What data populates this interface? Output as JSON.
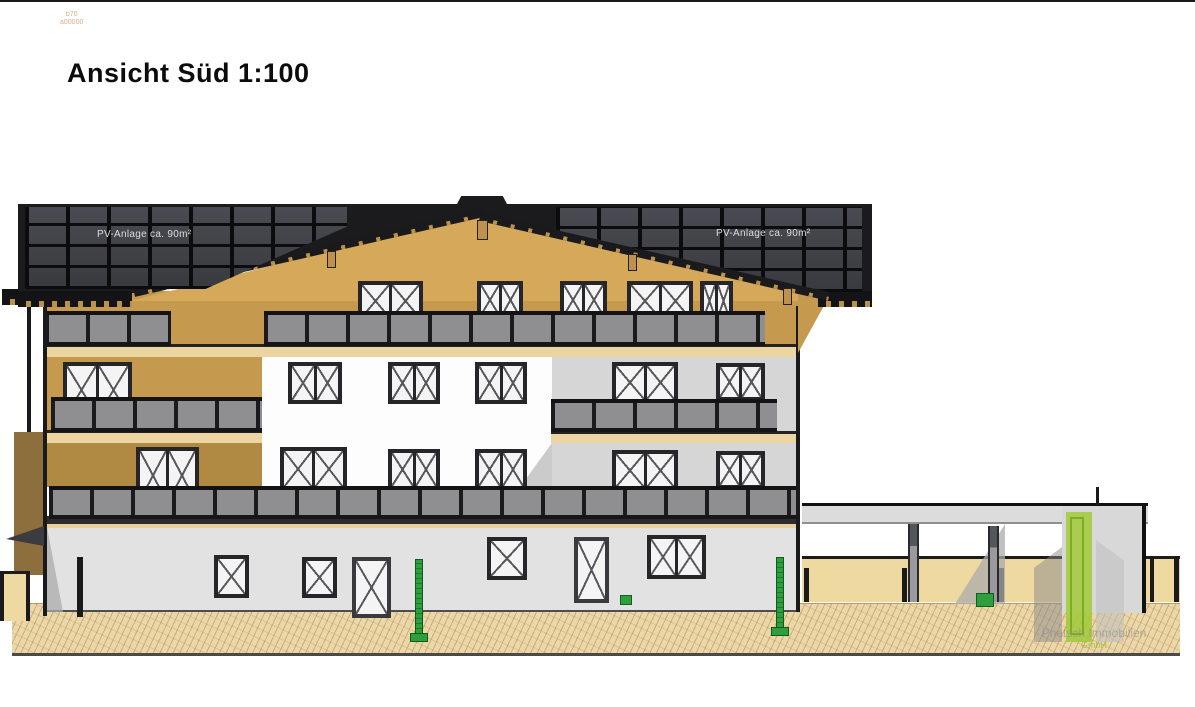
{
  "drawing": {
    "view": "Ansicht Süd",
    "scale": "1:100",
    "type": "architectural elevation"
  },
  "title": {
    "text": "Ansicht Süd 1:100"
  },
  "stamp": {
    "line1": "b70",
    "line2": "a00000"
  },
  "annotations": {
    "pv_left": "PV-Anlage ca. 90m²",
    "pv_right": "PV-Anlage ca. 90m²"
  },
  "logo": {
    "line1": "Prietsch Immobilien",
    "line2": "GmbH",
    "green": "#a3c93c",
    "gray": "#9a9a9a"
  },
  "colors": {
    "facade_wood": "#c69a4e",
    "facade_white": "#fdfdfd",
    "facade_gray": "#d6d6d6",
    "ground_floor": "#e2e2e2",
    "roof": "#1b1b1e",
    "pv_panel": "#43444a",
    "railing": "#8f8f92",
    "ground": "#ecd7a8",
    "bollard_green": "#2f9e3d"
  },
  "elevation": {
    "layers": [
      {
        "x": 0,
        "y": 0,
        "w": 1195,
        "h": 2,
        "c": "toprule",
        "n": "page-top-rule"
      },
      {
        "x": 12,
        "y": 603,
        "w": 1168,
        "h": 53,
        "c": "ground",
        "n": "ground-hatch"
      },
      {
        "x": 44,
        "y": 291,
        "w": 756,
        "h": 62,
        "c": "tan",
        "n": "attic-wall"
      },
      {
        "x": 130,
        "y": 213,
        "w": 706,
        "h": 88,
        "c": "tan-light",
        "n": "gable-wall",
        "cp": "polygon(50% 0%,100% 100%,0% 100%)"
      },
      {
        "x": 44,
        "y": 352,
        "w": 218,
        "h": 135,
        "c": "tan",
        "n": "left-wing-wall"
      },
      {
        "x": 44,
        "y": 443,
        "w": 218,
        "h": 44,
        "c": "tan-dark",
        "n": "left-wing-wall-shaded"
      },
      {
        "x": 262,
        "y": 352,
        "w": 290,
        "h": 135,
        "c": "white-wall",
        "n": "center-wall"
      },
      {
        "x": 520,
        "y": 443,
        "w": 32,
        "h": 44,
        "c": "shadow",
        "n": "center-wall-shadow",
        "cp": "polygon(100% 0,100% 100%,0 100%)"
      },
      {
        "x": 552,
        "y": 352,
        "w": 246,
        "h": 135,
        "c": "gray-wall",
        "n": "right-wing-wall"
      },
      {
        "x": 47,
        "y": 527,
        "w": 751,
        "h": 85,
        "c": "gf-wall",
        "n": "ground-floor-wall"
      },
      {
        "x": 47,
        "y": 527,
        "w": 16,
        "h": 85,
        "c": "shadow2",
        "n": "ground-floor-shadow",
        "cp": "polygon(0 0,100% 100%,0 100%)"
      },
      {
        "x": 44,
        "y": 344,
        "w": 754,
        "h": 13,
        "c": "band",
        "n": "floor-band-attic"
      },
      {
        "x": 44,
        "y": 430,
        "w": 218,
        "h": 13,
        "c": "band",
        "n": "floor-band-left"
      },
      {
        "x": 551,
        "y": 431,
        "w": 247,
        "h": 12,
        "c": "band",
        "n": "floor-band-right"
      },
      {
        "x": 44,
        "y": 516,
        "w": 754,
        "h": 12,
        "c": "band-dark",
        "n": "floor-band-ground"
      },
      {
        "t": "win",
        "x": 358,
        "y": 281,
        "w": 65,
        "h": 40,
        "p": 2,
        "n": "attic-window"
      },
      {
        "t": "win",
        "x": 477,
        "y": 281,
        "w": 46,
        "h": 38,
        "p": 2,
        "n": "attic-window"
      },
      {
        "t": "win",
        "x": 560,
        "y": 281,
        "w": 47,
        "h": 38,
        "p": 2,
        "n": "attic-window"
      },
      {
        "t": "win",
        "x": 627,
        "y": 281,
        "w": 66,
        "h": 40,
        "p": 2,
        "n": "attic-window"
      },
      {
        "t": "win",
        "x": 700,
        "y": 281,
        "w": 33,
        "h": 40,
        "p": 2,
        "n": "attic-window"
      },
      {
        "t": "win",
        "x": 63,
        "y": 362,
        "w": 69,
        "h": 56,
        "p": 2,
        "n": "upper-window"
      },
      {
        "t": "win",
        "x": 288,
        "y": 362,
        "w": 54,
        "h": 42,
        "p": 2,
        "n": "upper-window"
      },
      {
        "t": "win",
        "x": 388,
        "y": 362,
        "w": 52,
        "h": 42,
        "p": 2,
        "n": "upper-window"
      },
      {
        "t": "win",
        "x": 475,
        "y": 362,
        "w": 52,
        "h": 42,
        "p": 2,
        "n": "upper-window"
      },
      {
        "t": "win",
        "x": 612,
        "y": 362,
        "w": 66,
        "h": 41,
        "p": 2,
        "n": "upper-window"
      },
      {
        "t": "win",
        "x": 716,
        "y": 363,
        "w": 49,
        "h": 38,
        "p": 2,
        "n": "upper-window"
      },
      {
        "t": "win",
        "x": 136,
        "y": 447,
        "w": 63,
        "h": 57,
        "p": 2,
        "n": "first-floor-window"
      },
      {
        "t": "win",
        "x": 280,
        "y": 447,
        "w": 67,
        "h": 44,
        "p": 2,
        "n": "first-floor-window"
      },
      {
        "t": "win",
        "x": 388,
        "y": 449,
        "w": 52,
        "h": 41,
        "p": 2,
        "n": "first-floor-window"
      },
      {
        "t": "win",
        "x": 475,
        "y": 449,
        "w": 52,
        "h": 41,
        "p": 2,
        "n": "first-floor-window"
      },
      {
        "t": "win",
        "x": 612,
        "y": 450,
        "w": 66,
        "h": 41,
        "p": 2,
        "n": "first-floor-window"
      },
      {
        "t": "win",
        "x": 716,
        "y": 451,
        "w": 49,
        "h": 38,
        "p": 2,
        "n": "first-floor-window"
      },
      {
        "t": "win",
        "x": 214,
        "y": 555,
        "w": 35,
        "h": 43,
        "p": 1,
        "n": "ground-window"
      },
      {
        "t": "win",
        "x": 302,
        "y": 557,
        "w": 35,
        "h": 41,
        "p": 1,
        "n": "ground-window"
      },
      {
        "t": "win",
        "x": 352,
        "y": 557,
        "w": 39,
        "h": 61,
        "p": 1,
        "door": true,
        "n": "entrance-door"
      },
      {
        "t": "win",
        "x": 487,
        "y": 537,
        "w": 40,
        "h": 43,
        "p": 1,
        "n": "ground-window"
      },
      {
        "t": "win",
        "x": 574,
        "y": 537,
        "w": 35,
        "h": 66,
        "p": 1,
        "door": true,
        "n": "entrance-door"
      },
      {
        "t": "win",
        "x": 647,
        "y": 535,
        "w": 59,
        "h": 44,
        "p": 2,
        "n": "ground-window"
      },
      {
        "t": "rail",
        "x": 45,
        "y": 311,
        "w": 126,
        "h": 35,
        "n": "balcony-railing-attic-left"
      },
      {
        "t": "rail",
        "x": 264,
        "y": 311,
        "w": 501,
        "h": 35,
        "n": "balcony-railing-attic"
      },
      {
        "t": "rail",
        "x": 51,
        "y": 397,
        "w": 211,
        "h": 35,
        "n": "balcony-railing-upper-left"
      },
      {
        "t": "rail",
        "x": 551,
        "y": 399,
        "w": 226,
        "h": 33,
        "n": "balcony-railing-upper-right"
      },
      {
        "t": "rail",
        "x": 49,
        "y": 486,
        "w": 749,
        "h": 33,
        "n": "balcony-railing-first-floor"
      },
      {
        "x": 796,
        "y": 306,
        "w": 4,
        "h": 306,
        "c": "line",
        "n": "building-right-edge"
      },
      {
        "x": 43,
        "y": 298,
        "w": 4,
        "h": 318,
        "c": "line",
        "n": "downspout"
      },
      {
        "x": 27,
        "y": 295,
        "w": 4,
        "h": 140,
        "c": "line",
        "n": "left-balcony-edge"
      },
      {
        "x": 18,
        "y": 306,
        "w": 9,
        "h": 11,
        "c": "white-wall",
        "n": "side-window"
      },
      {
        "x": 2,
        "y": 289,
        "w": 17,
        "h": 16,
        "c": "eave",
        "n": "gutter-end"
      },
      {
        "x": 14,
        "y": 432,
        "w": 29,
        "h": 143,
        "c": "olive",
        "n": "side-wall"
      },
      {
        "x": 6,
        "y": 526,
        "w": 38,
        "h": 20,
        "c": "awning",
        "n": "entrance-canopy",
        "cp": "polygon(0 65%,100% 0,100% 100%)"
      },
      {
        "x": 0,
        "y": 571,
        "w": 30,
        "h": 50,
        "c": "lowwall",
        "n": "left-garden-wall"
      },
      {
        "x": 0,
        "y": 571,
        "w": 4,
        "h": 50,
        "c": "line",
        "n": "wall-post"
      },
      {
        "x": 26,
        "y": 571,
        "w": 4,
        "h": 50,
        "c": "line",
        "n": "wall-post"
      },
      {
        "x": 77,
        "y": 557,
        "w": 6,
        "h": 60,
        "c": "line",
        "n": "gate-post"
      },
      {
        "x": 798,
        "y": 291,
        "w": 34,
        "h": 62,
        "c": "tan",
        "n": "attic-eave-return",
        "cp": "polygon(0 0,100% 0,0 100%)"
      },
      {
        "x": 18,
        "y": 204,
        "w": 854,
        "h": 89,
        "c": "roof",
        "n": "roof",
        "cp": "polygon(0 0,100% 0,100% 100%,94.8% 100%,54.4% 11.2%,14.1% 100%,0 100%)"
      },
      {
        "x": 18,
        "y": 291,
        "w": 114,
        "h": 16,
        "c": "eave",
        "n": "eave-left"
      },
      {
        "x": 818,
        "y": 291,
        "w": 54,
        "h": 16,
        "c": "eave",
        "n": "eave-right"
      },
      {
        "x": 134,
        "y": 288,
        "w": 358,
        "h": 9,
        "c": "fascia",
        "n": "gable-fascia-left",
        "tr": "rotate(-12.9deg)",
        "to": "0 50%"
      },
      {
        "x": 480,
        "y": 212,
        "w": 358,
        "h": 9,
        "c": "fascia",
        "n": "gable-fascia-right",
        "tr": "rotate(12.9deg)",
        "to": "0 50%"
      },
      {
        "x": 456,
        "y": 196,
        "w": 52,
        "h": 10,
        "c": "roof",
        "n": "ridge-cap",
        "cp": "polygon(0 100%,10% 0,90% 0,100% 100%)"
      },
      {
        "x": 25,
        "y": 207,
        "w": 322,
        "h": 82,
        "c": "pv",
        "n": "pv-array-left",
        "cp": "polygon(0 0,100% 0,100% 24%,56% 100%,0 100%)"
      },
      {
        "x": 556,
        "y": 207,
        "w": 306,
        "h": 85,
        "c": "pv",
        "n": "pv-array-right",
        "cp": "polygon(0 0,100% 0,100% 100%,88.9% 100%,0 27%)"
      },
      {
        "x": 477,
        "y": 220,
        "w": 11,
        "h": 20,
        "c": "hanger",
        "n": "roof-bracket"
      },
      {
        "x": 327,
        "y": 251,
        "w": 9,
        "h": 17,
        "c": "hanger",
        "n": "roof-bracket"
      },
      {
        "x": 628,
        "y": 254,
        "w": 9,
        "h": 17,
        "c": "hanger",
        "n": "roof-bracket"
      },
      {
        "x": 783,
        "y": 288,
        "w": 9,
        "h": 17,
        "c": "hanger",
        "n": "roof-bracket"
      },
      {
        "x": 802,
        "y": 503,
        "w": 346,
        "h": 21,
        "c": "slab",
        "n": "carport-roof"
      },
      {
        "x": 802,
        "y": 556,
        "w": 346,
        "h": 46,
        "c": "lowwall",
        "n": "carport-back-wall"
      },
      {
        "x": 1148,
        "y": 556,
        "w": 32,
        "h": 46,
        "c": "lowwall",
        "n": "garden-wall-right"
      },
      {
        "x": 804,
        "y": 568,
        "w": 5,
        "h": 34,
        "c": "line",
        "n": "wall-post"
      },
      {
        "x": 902,
        "y": 568,
        "w": 5,
        "h": 34,
        "c": "line",
        "n": "wall-post"
      },
      {
        "x": 999,
        "y": 568,
        "w": 5,
        "h": 34,
        "c": "line",
        "n": "wall-post"
      },
      {
        "x": 1150,
        "y": 556,
        "w": 4,
        "h": 46,
        "c": "line",
        "n": "wall-post"
      },
      {
        "x": 1174,
        "y": 556,
        "w": 5,
        "h": 46,
        "c": "line",
        "n": "wall-post"
      },
      {
        "x": 955,
        "y": 524,
        "w": 50,
        "h": 80,
        "c": "shadow2",
        "n": "carport-shadow",
        "cp": "polygon(100% 0,100% 100%,0 100%)"
      },
      {
        "x": 908,
        "y": 524,
        "w": 11,
        "h": 78,
        "c": "cpost",
        "n": "carport-post"
      },
      {
        "x": 988,
        "y": 526,
        "w": 11,
        "h": 76,
        "c": "cpost",
        "n": "carport-post"
      },
      {
        "x": 1062,
        "y": 503,
        "w": 84,
        "h": 110,
        "c": "tower",
        "n": "stair-tower"
      },
      {
        "x": 1096,
        "y": 487,
        "w": 3,
        "h": 18,
        "c": "line",
        "n": "roof-vent"
      },
      {
        "x": 976,
        "y": 593,
        "w": 18,
        "h": 14,
        "c": "gmark",
        "n": "survey-marker"
      },
      {
        "x": 620,
        "y": 595,
        "w": 12,
        "h": 10,
        "c": "gmark",
        "n": "survey-marker"
      },
      {
        "t": "bol",
        "x": 410,
        "y": 559,
        "w": 18,
        "h": 83,
        "n": "green-bollard"
      },
      {
        "t": "bol",
        "x": 771,
        "y": 557,
        "w": 18,
        "h": 79,
        "n": "green-bollard"
      },
      {
        "x": 1034,
        "y": 547,
        "w": 28,
        "h": 95,
        "c": "",
        "n": "logo-bar-gray",
        "bg": "#8a8a8a",
        "o": ".5",
        "cp": "polygon(0 22%,100% 0,100% 100%,0 100%)"
      },
      {
        "x": 1066,
        "y": 512,
        "w": 26,
        "h": 130,
        "c": "",
        "n": "logo-bar-green",
        "bg": "#a3c93c",
        "o": ".88"
      },
      {
        "x": 1070,
        "y": 517,
        "w": 14,
        "h": 118,
        "c": "gin",
        "n": "logo-bar-green-inner"
      },
      {
        "x": 1096,
        "y": 540,
        "w": 28,
        "h": 102,
        "c": "",
        "n": "logo-bar-lightgray",
        "bg": "#c0c0c0",
        "o": ".55",
        "cp": "polygon(0 0,100% 20%,100% 100%,0 100%)"
      }
    ]
  }
}
